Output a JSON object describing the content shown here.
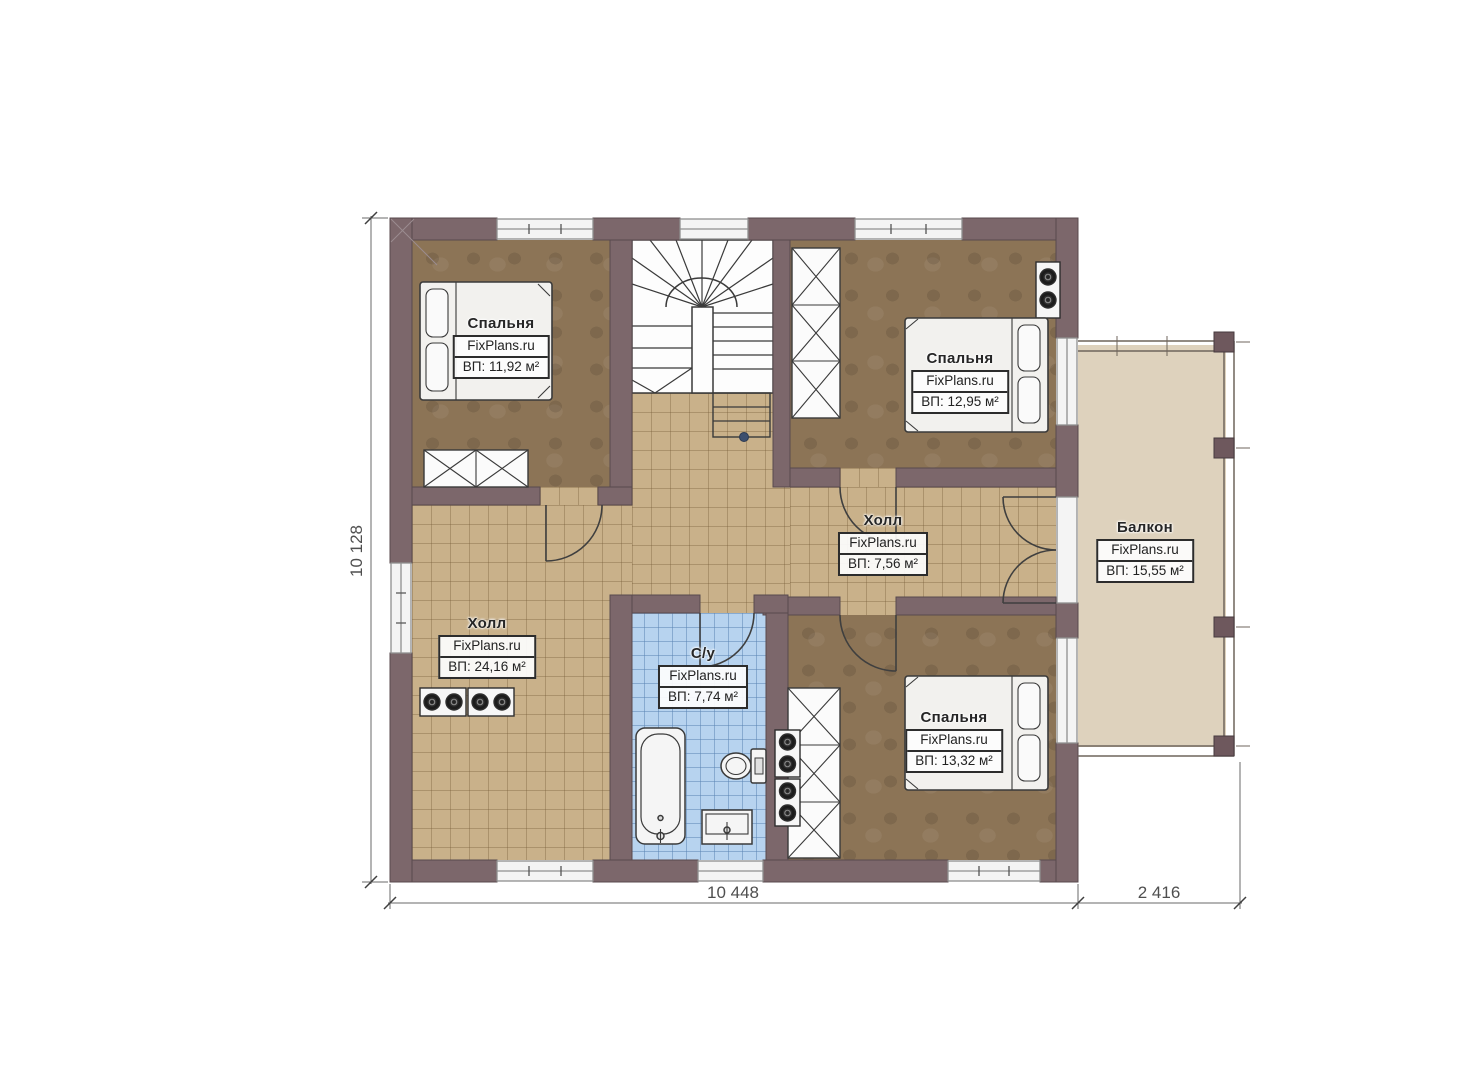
{
  "plan": {
    "brand": "FixPlans.ru",
    "labels": {
      "bedroom_tl": {
        "name": "Спальня",
        "area": "ВП: 11,92 м²"
      },
      "bedroom_tr": {
        "name": "Спальня",
        "area": "ВП: 12,95 м²"
      },
      "hall_mid": {
        "name": "Холл",
        "area": "ВП: 7,56 м²"
      },
      "balcony": {
        "name": "Балкон",
        "area": "ВП: 15,55 м²"
      },
      "hall_left": {
        "name": "Холл",
        "area": "ВП: 24,16 м²"
      },
      "bath": {
        "name": "С/у",
        "area": "ВП: 7,74 м²"
      },
      "bedroom_br": {
        "name": "Спальня",
        "area": "ВП: 13,32 м²"
      }
    },
    "dimensions": {
      "height": "10 128",
      "width_main": "10 448",
      "width_balcony": "2 416"
    },
    "colors": {
      "wall": "#7c676b",
      "tile_tan": "#c9b18a",
      "tile_blue": "#b7d3ef",
      "floor_brown": "#8c7456",
      "balcony_floor": "#ded2bd",
      "window": "#f4f4f4",
      "stair_marker": "#3d4f6e"
    }
  }
}
